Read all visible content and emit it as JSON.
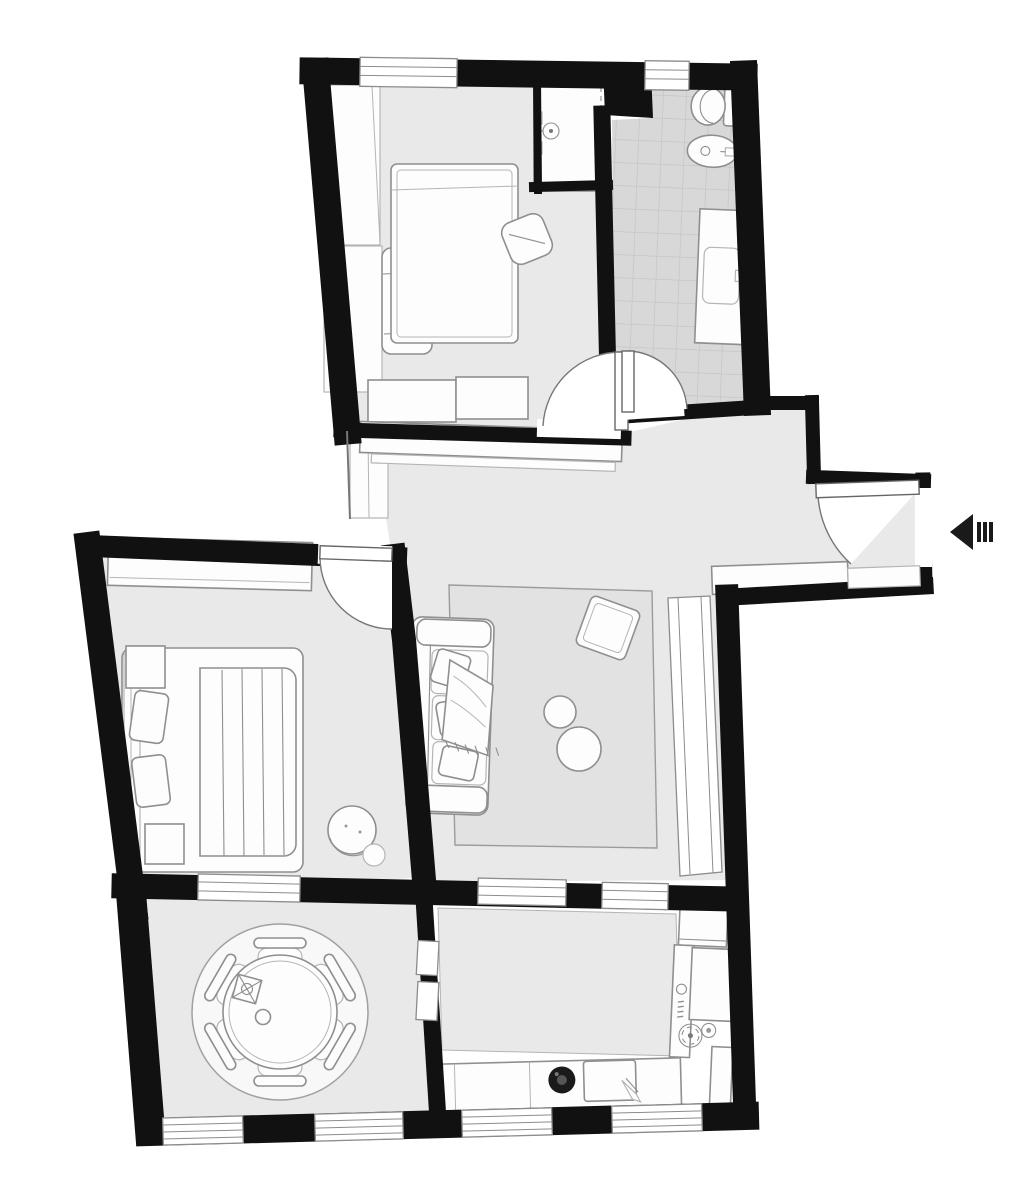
{
  "meta": {
    "type": "apartment-floor-plan",
    "style": "monochrome black-wall plan, top-down view",
    "text_labels": "none visible"
  },
  "colors": {
    "wall": "#111111",
    "floor": "#e9e9e9",
    "tile": "#d8d8d8",
    "tileline": "#c2c2c2",
    "line": "#8f8f8f",
    "furn": "#fdfdfd",
    "bg": "#ffffff",
    "rug": "#e2e2e2",
    "dining-rug": "#f8f8f8",
    "dark": "#1a1a1a"
  },
  "entrance": {
    "icon": "entrance-arrow-icon",
    "direction": "left",
    "location": "right wall of entry nook",
    "bars": 3
  },
  "rooms": [
    {
      "id": "bedroom-1",
      "position": "top-left",
      "floor": "light-gray",
      "windows": 2,
      "items": [
        "wardrobe-icon",
        "bench-icon",
        "bed-icon",
        "desk-icon",
        "desk-chair-icon",
        "door-swing-icon"
      ]
    },
    {
      "id": "bathroom",
      "position": "top-right",
      "floor": "gray-tile-grid",
      "windows": 1,
      "items": [
        "shower-icon",
        "toilet-icon",
        "bidet-icon",
        "vanity-sink-icon",
        "door-swing-icon"
      ]
    },
    {
      "id": "hall-entry",
      "position": "center-right",
      "floor": "light-gray",
      "windows": 0,
      "items": [
        "closet-icon",
        "console-table-icon",
        "shoe-bench-icon",
        "threshold-icon",
        "entry-door-swing-icon"
      ]
    },
    {
      "id": "living-room",
      "position": "center",
      "floor": "light-gray",
      "windows": 1,
      "items": [
        "sofa-icon",
        "throw-blanket-icon",
        "area-rug-icon",
        "coffee-table-small-icon",
        "coffee-table-large-icon",
        "pouf-icon",
        "tall-window-icon"
      ]
    },
    {
      "id": "bedroom-2",
      "position": "middle-left",
      "floor": "light-gray",
      "windows": 1,
      "items": [
        "wardrobe-icon",
        "double-bed-icon",
        "nightstand-icon",
        "nightstand-icon",
        "armchair-icon",
        "door-swing-icon"
      ]
    },
    {
      "id": "dining-room",
      "position": "bottom-left",
      "floor": "light-gray",
      "windows": 2,
      "items": [
        "round-rug-icon",
        "round-table-icon",
        "dining-chair-icon",
        "centerpiece-icon",
        "passage-dashed-opening-icon"
      ],
      "chairs": 6
    },
    {
      "id": "kitchen",
      "position": "bottom-right",
      "floor": "white-with-gray-rug",
      "windows": 3,
      "items": [
        "fridge-icon",
        "counter-icon",
        "cooktop-burners-icon",
        "tall-cabinet-icon",
        "round-sink-icon",
        "cutting-board-knife-icon",
        "kitchen-rug-icon"
      ]
    }
  ],
  "doors": {
    "interior_swings": 4,
    "entry_swings": 1,
    "dashed_passages": 1
  },
  "window_count_total": 9
}
